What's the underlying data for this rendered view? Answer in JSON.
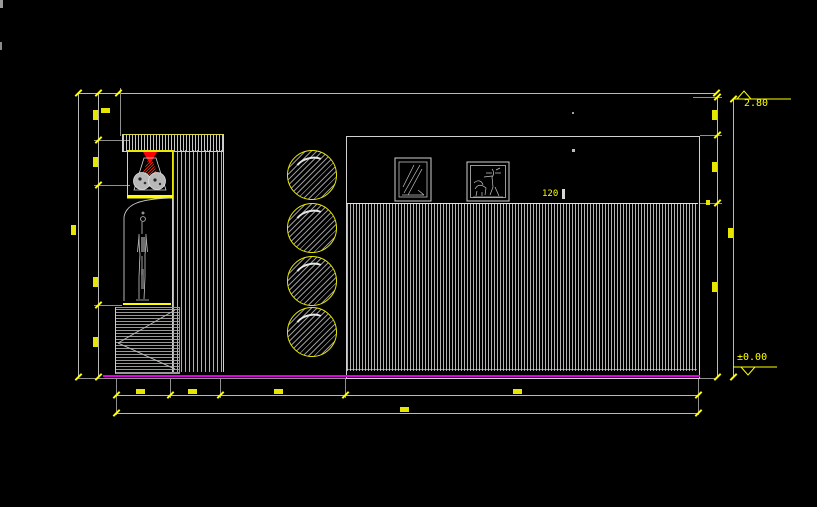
{
  "drawing": {
    "type": "cad-interior-elevation",
    "background": "#000000",
    "annotations": {
      "level_top_label": "2.80",
      "level_bottom_label": "±0.00",
      "paneling_dim_label": "120"
    },
    "colors": {
      "line": "#cfcfcf",
      "hatch": "#b0b0b0",
      "dimension_accent": "#ffff00",
      "floor_line": "#e100e1",
      "artwork_red": "#ff0000"
    }
  }
}
